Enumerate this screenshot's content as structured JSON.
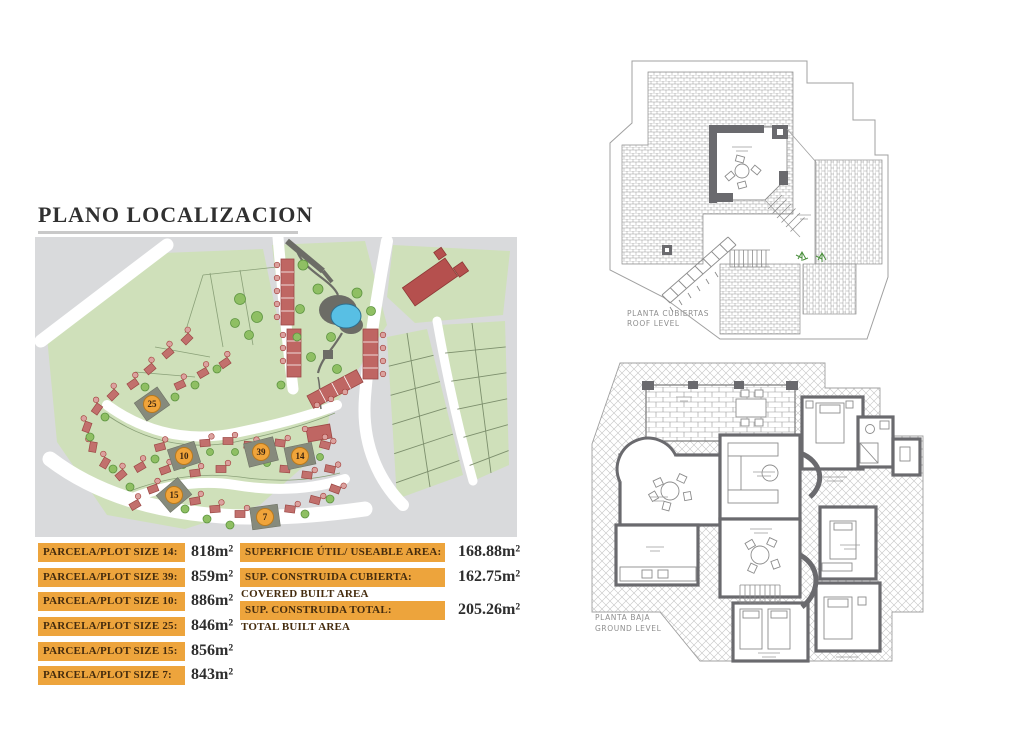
{
  "document": {
    "title": "PLANO LOCALIZACION"
  },
  "plot_sizes": {
    "rows": [
      {
        "label": "PARCELA/PLOT SIZE 14:",
        "value": "818m²"
      },
      {
        "label": "PARCELA/PLOT SIZE 39:",
        "value": "859m²"
      },
      {
        "label": "PARCELA/PLOT SIZE 10:",
        "value": "886m²"
      },
      {
        "label": "PARCELA/PLOT SIZE 25:",
        "value": "846m²"
      },
      {
        "label": "PARCELA/PLOT SIZE 15:",
        "value": "856m²"
      },
      {
        "label": "PARCELA/PLOT SIZE 7:",
        "value": "843m²"
      }
    ]
  },
  "areas": {
    "rows": [
      {
        "label": "SUPERFICIE ÚTIL/ USEABLE AREA:",
        "value": "168.88m²",
        "sublabel": ""
      },
      {
        "label": "SUP. CONSTRUIDA CUBIERTA:",
        "value": "162.75m²",
        "sublabel": "COVERED BUILT AREA"
      },
      {
        "label": "SUP. CONSTRUIDA TOTAL:",
        "value": "205.26m²",
        "sublabel": "TOTAL BUILT AREA"
      }
    ]
  },
  "site_map": {
    "highlighted_plots": [
      "25",
      "10",
      "15",
      "39",
      "14",
      "7"
    ],
    "colors": {
      "background": "#d9dadc",
      "land": "#cfe0ba",
      "road": "#ffffff",
      "house": "#c2706d",
      "row_house": "#bf6663",
      "tree": "#8fbf63",
      "pond": "#58bfe4",
      "highlight_plot": "#868a7c",
      "badge": "#f0a43a"
    }
  },
  "floor_plans": {
    "roof": {
      "label_line1": "PLANTA CUBIERTAS",
      "label_line2": "ROOF LEVEL"
    },
    "ground": {
      "label_line1": "PLANTA BAJA",
      "label_line2": "GROUND LEVEL"
    }
  }
}
